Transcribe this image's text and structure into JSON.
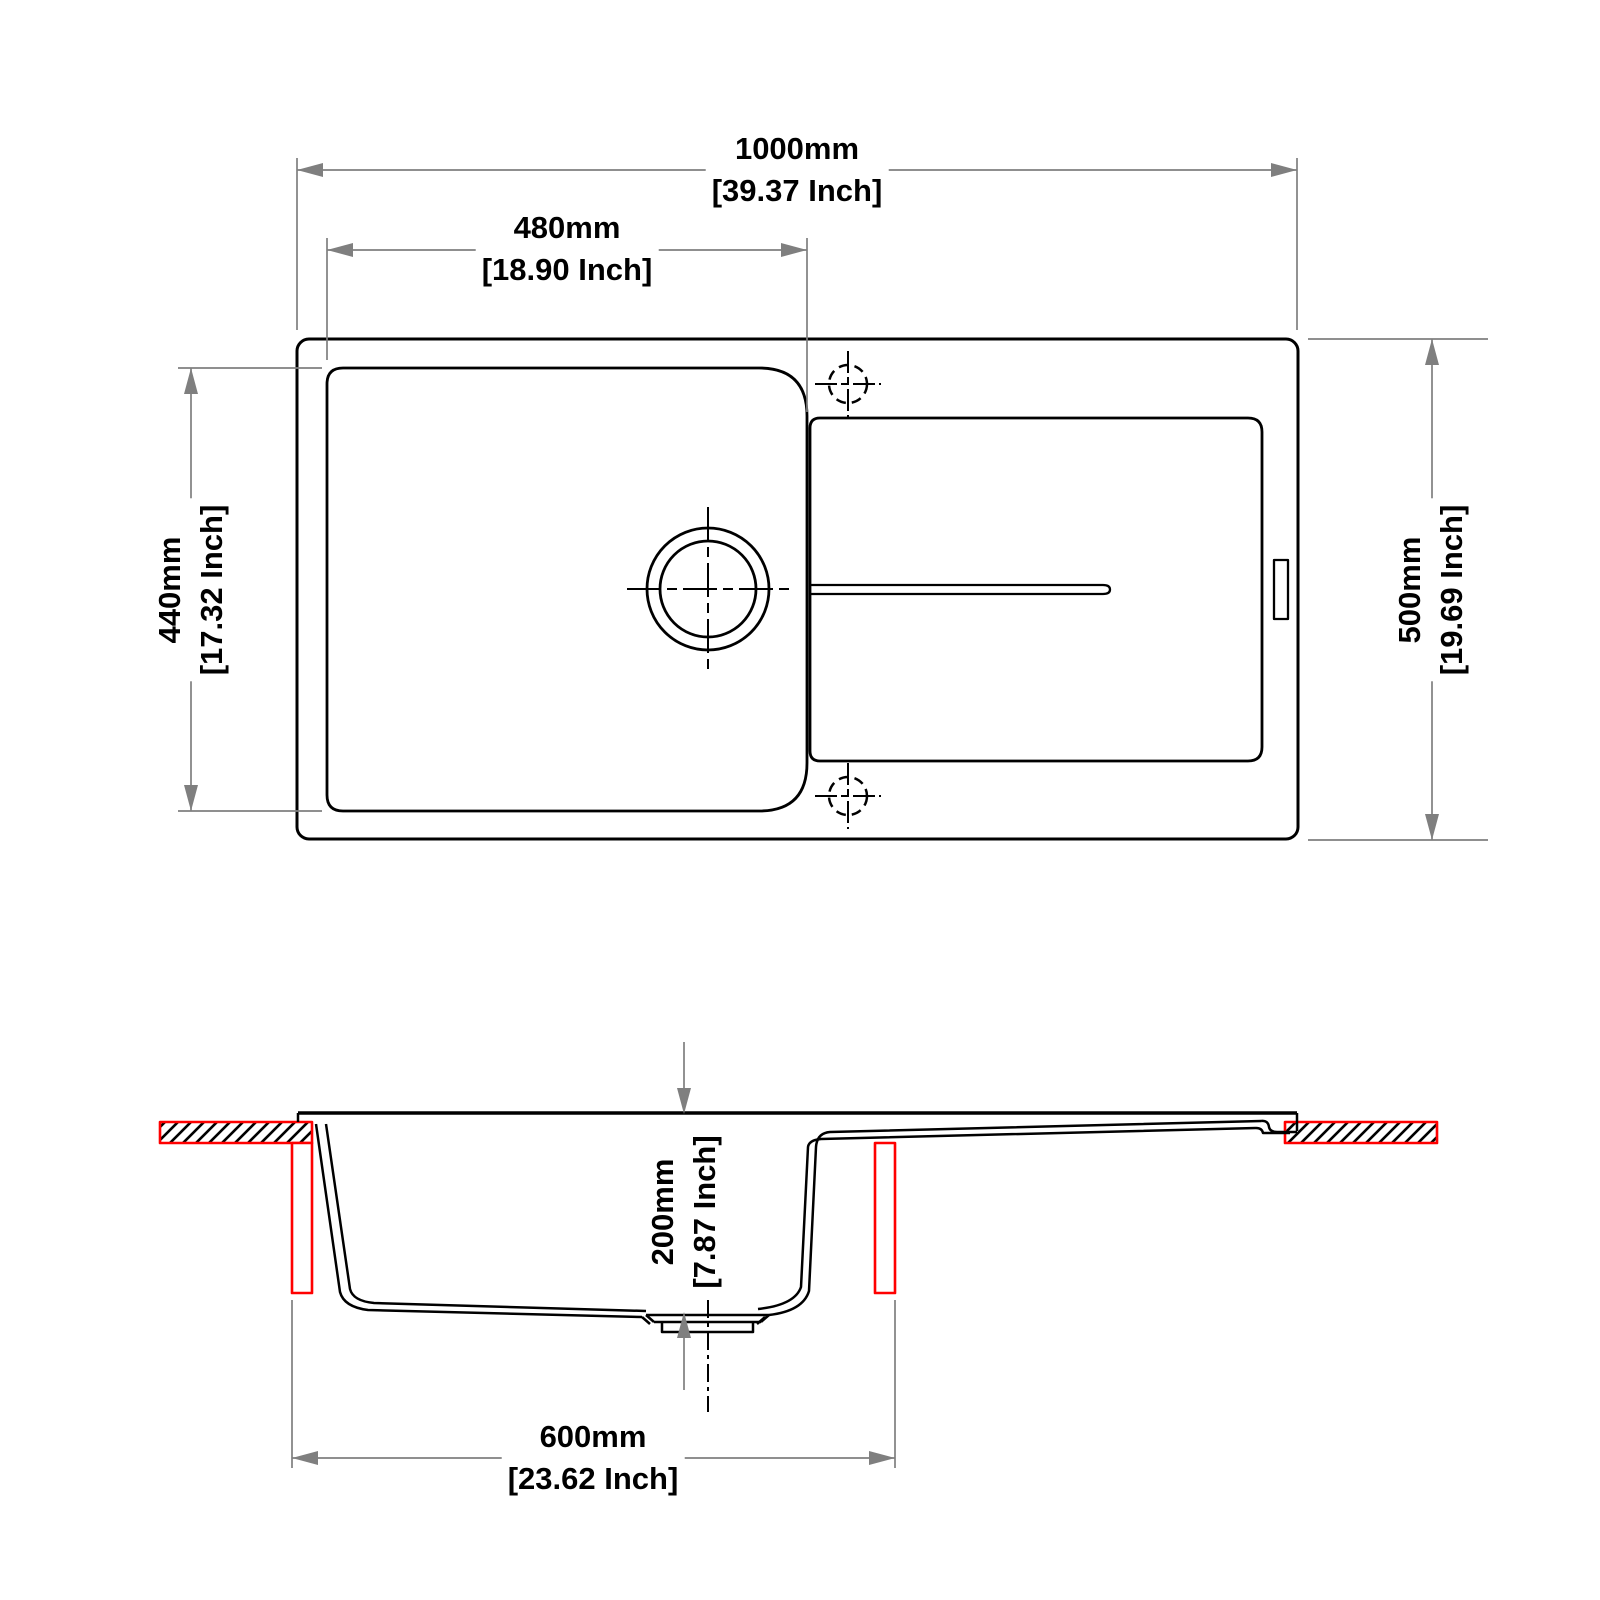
{
  "colors": {
    "line": "#000000",
    "dimension_line": "#7f7f7f",
    "highlight_red": "#ff0000",
    "background": "#ffffff"
  },
  "dimensions": {
    "overall_width": {
      "mm": "1000mm",
      "inch": "[39.37 Inch]"
    },
    "bowl_width": {
      "mm": "480mm",
      "inch": "[18.90 Inch]"
    },
    "bowl_length": {
      "mm": "440mm",
      "inch": "[17.32 Inch]"
    },
    "overall_depth": {
      "mm": "500mm",
      "inch": "[19.69 Inch]"
    },
    "bowl_depth": {
      "mm": "200mm",
      "inch": "[7.87 Inch]"
    },
    "cabinet_width": {
      "mm": "600mm",
      "inch": "[23.62 Inch]"
    }
  }
}
